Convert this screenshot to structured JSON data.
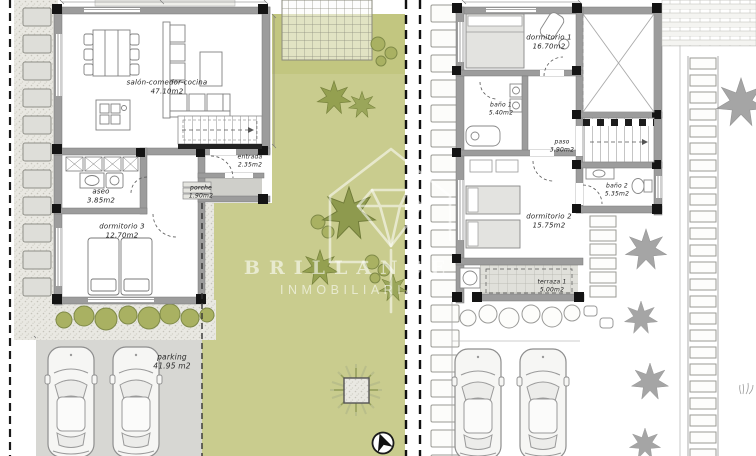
{
  "watermark": {
    "brand": "BRILLANCE",
    "subtitle": "INMOBILIARIA"
  },
  "ground_floor": {
    "salon": {
      "name": "salón-comedor-cocina",
      "area": "47.10m2"
    },
    "aseo": {
      "name": "aseo",
      "area": "3.85m2"
    },
    "entrada": {
      "name": "entrada",
      "area": "2.35m2"
    },
    "porche": {
      "name": "porche",
      "area": "1.90m2"
    },
    "dormitorio3": {
      "name": "dormitorio 3",
      "area": "12.70m2"
    },
    "parking": {
      "name": "parking",
      "area": "41.95 m2"
    }
  },
  "first_floor": {
    "dormitorio1": {
      "name": "dormitorio 1",
      "area": "16.70m2"
    },
    "bano1": {
      "name": "baño 1",
      "area": "5.40m2"
    },
    "paso": {
      "name": "paso",
      "area": "3.90m2"
    },
    "bano2": {
      "name": "baño 2",
      "area": "5.35m2"
    },
    "dormitorio2": {
      "name": "dormitorio 2",
      "area": "15.75m2"
    },
    "terraza1": {
      "name": "terraza 1",
      "area": "5.00m2"
    }
  },
  "icons": {
    "north_arrow": "north-arrow-in-circle"
  },
  "colors": {
    "garden_green": "#c9cc8e",
    "plant_green": "#94a050",
    "wall_gray": "#9c9c9c",
    "post_black": "#141414",
    "parking_gray": "#d7d7d3",
    "gravel_beige": "#e9e8e2",
    "grayscale_plant": "#9c9c9c",
    "watermark_white": "rgba(255,255,255,0.55)"
  }
}
